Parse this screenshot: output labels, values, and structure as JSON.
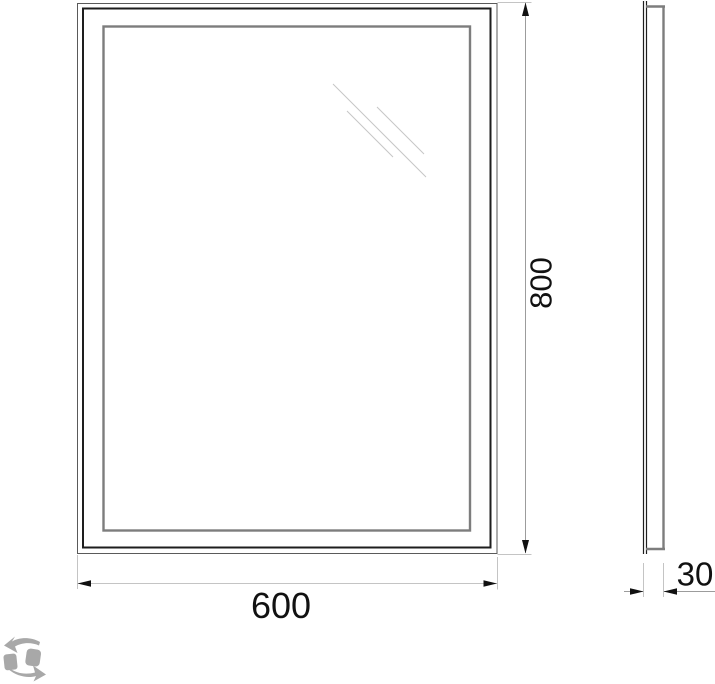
{
  "page": {
    "background": "#ffffff"
  },
  "drawing": {
    "type": "mirror-dimension-drawing",
    "front_view": {
      "width_dim": {
        "value": "600"
      },
      "height_dim": {
        "value": "800"
      }
    },
    "side_view": {
      "depth_dim": {
        "value": "30"
      }
    },
    "watermark_icon": "recycle-arrows-icon",
    "colors": {
      "line_outer": "#5a5a5a",
      "line_dark": "#1e1e1e",
      "line_frame": "#7d7d7d",
      "line_ext": "#c4c4c4",
      "line_dim": "#9c9c9c",
      "line_hatch": "#c6c6c6",
      "line_arrow": "#111111",
      "watermark": "#a8a8a8",
      "text": "#111111",
      "background": "#ffffff"
    }
  }
}
